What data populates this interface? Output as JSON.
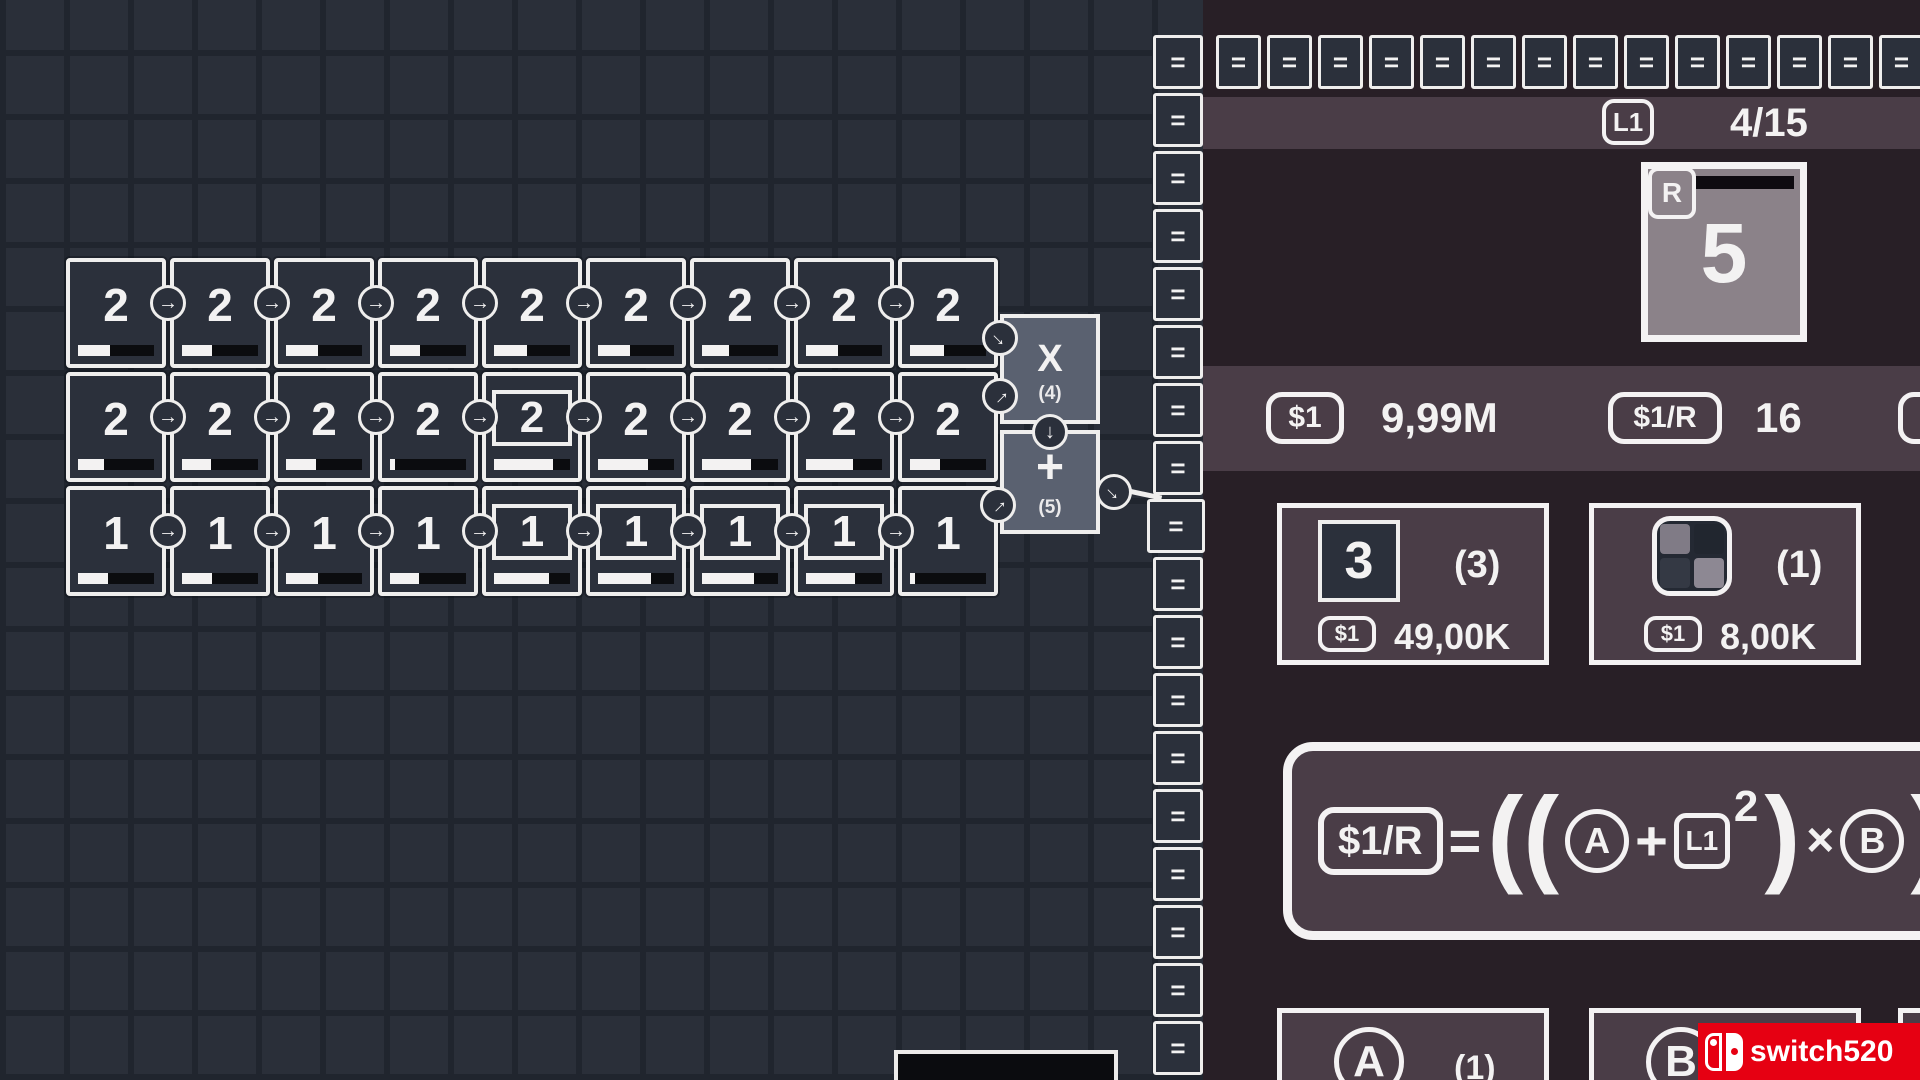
{
  "icons": {
    "arrow_right": "→",
    "arrow_down": "↓",
    "grid_2x2_icon": "grid-2x2",
    "switch_logo_icon": "nintendo-switch"
  },
  "colors": {
    "accent_red": "#e60012",
    "panel_plum": "#281f26",
    "panel_mauve": "#4a3d47",
    "operator_slate": "#5a6170",
    "tile_dark": "#2b303b",
    "result_card_gray": "#8b8289"
  },
  "board": {
    "rows": [
      {
        "cells": [
          {
            "value": "2",
            "boxed": false,
            "progress": 0.42
          },
          {
            "value": "2",
            "boxed": false,
            "progress": 0.4
          },
          {
            "value": "2",
            "boxed": false,
            "progress": 0.42
          },
          {
            "value": "2",
            "boxed": false,
            "progress": 0.4
          },
          {
            "value": "2",
            "boxed": false,
            "progress": 0.44
          },
          {
            "value": "2",
            "boxed": false,
            "progress": 0.42
          },
          {
            "value": "2",
            "boxed": false,
            "progress": 0.36
          },
          {
            "value": "2",
            "boxed": false,
            "progress": 0.42
          },
          {
            "value": "2",
            "boxed": false,
            "progress": 0.45
          }
        ]
      },
      {
        "cells": [
          {
            "value": "2",
            "boxed": false,
            "progress": 0.34
          },
          {
            "value": "2",
            "boxed": false,
            "progress": 0.38
          },
          {
            "value": "2",
            "boxed": false,
            "progress": 0.4
          },
          {
            "value": "2",
            "boxed": false,
            "progress": 0.06
          },
          {
            "value": "2",
            "boxed": true,
            "progress": 0.78
          },
          {
            "value": "2",
            "boxed": false,
            "progress": 0.66
          },
          {
            "value": "2",
            "boxed": false,
            "progress": 0.64
          },
          {
            "value": "2",
            "boxed": false,
            "progress": 0.62
          },
          {
            "value": "2",
            "boxed": false,
            "progress": 0.4
          }
        ]
      },
      {
        "cells": [
          {
            "value": "1",
            "boxed": false,
            "progress": 0.4
          },
          {
            "value": "1",
            "boxed": false,
            "progress": 0.4
          },
          {
            "value": "1",
            "boxed": false,
            "progress": 0.42
          },
          {
            "value": "1",
            "boxed": false,
            "progress": 0.38
          },
          {
            "value": "1",
            "boxed": true,
            "progress": 0.72
          },
          {
            "value": "1",
            "boxed": true,
            "progress": 0.7
          },
          {
            "value": "1",
            "boxed": true,
            "progress": 0.68
          },
          {
            "value": "1",
            "boxed": true,
            "progress": 0.64
          },
          {
            "value": "1",
            "boxed": false,
            "progress": 0.06
          }
        ]
      }
    ]
  },
  "operators": {
    "multiply_label": "X",
    "multiply_count": "(4)",
    "add_label": "+",
    "add_count": "(5)"
  },
  "equals": {
    "glyph": "=",
    "column_count": 18,
    "row_count": 14
  },
  "right_panel": {
    "header": {
      "level_badge": "L1",
      "progress": "4/15"
    },
    "result_card": {
      "corner_badge": "R",
      "value": "5"
    },
    "stats": {
      "money_badge": "$1",
      "money_value": "9,99M",
      "rate_badge": "$1/R",
      "rate_value": "16"
    },
    "shop": {
      "item1": {
        "tile_value": "3",
        "count": "(3)",
        "price_badge": "$1",
        "price": "49,00K"
      },
      "item2": {
        "count": "(1)",
        "price_badge": "$1",
        "price": "8,00K"
      }
    },
    "formula": {
      "lhs_badge": "$1/R",
      "equals": "=",
      "open_parens": "((",
      "var_a": "A",
      "plus": "+",
      "level_badge": "L1",
      "exponent": "2",
      "close_paren": ")",
      "times": "×",
      "var_b": "B",
      "trailing_paren": ")"
    },
    "bottom_cards": {
      "card_a_symbol": "A",
      "card_a_count": "(1)",
      "card_b_symbol": "B"
    }
  },
  "watermark": {
    "text": "switch520"
  }
}
